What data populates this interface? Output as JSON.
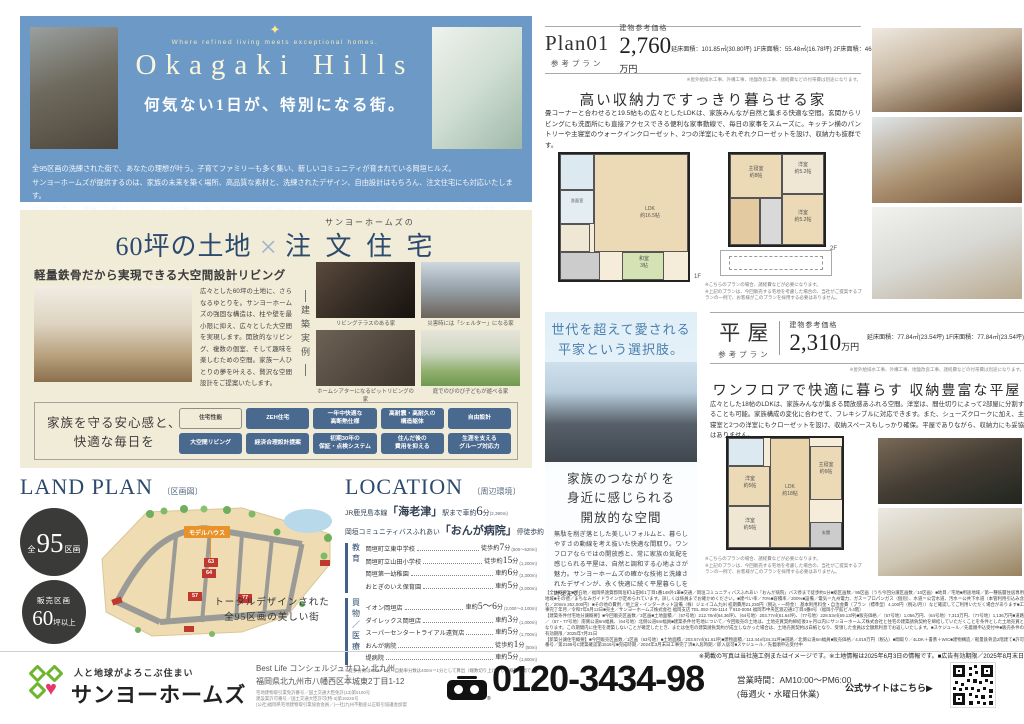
{
  "colors": {
    "hero_blue": "#6d99c6",
    "cream": "#f1ecd8",
    "navy": "#2c4a6e",
    "badge_blue": "#49698f",
    "lot_red": "#c0392f",
    "model_house_orange": "#e8922a",
    "brand_green": "#6cb52d",
    "brand_pink": "#e8366b"
  },
  "hero": {
    "sparkle_icon": "✦",
    "tagline": "Where refined living meets exceptional homes.",
    "title": "Okagaki Hills",
    "subtitle": "何気ない1日が、特別になる街。",
    "body_lines": [
      "全95区画の洗練された街で、あなたの理想が叶う。子育てファミリーも多く集い、新しいコミュニティが育まれている岡垣ヒルズ。",
      "サンヨーホームズが提供するのは、家族の未来を築く場所、高品質な素材と、洗練されたデザイン、自由設計はもちろん、注文住宅にも対応いたします。",
      "災害にも強く、健康にも優しい、安心・安全な暮らしを、岡垣HILLSでお約束します。毎日を特別なものに変える、リゾートのような心地よさを、ぜひご体感ください。"
    ]
  },
  "custom_home": {
    "brand_prefix": "サンヨーホームズの",
    "title_land": "60坪の土地",
    "title_x": "×",
    "title_home": "注 文 住 宅",
    "feature_heading": "軽量鉄骨だから実現できる大空間設計リビング",
    "feature_body": "広々とした60坪の土地に、さらなるゆとりを。サンヨーホームズの強固な構造は、柱や壁を最小限に抑え、広々とした大空間を実現します。開放的なリビング、複数の個室、そして趣味を楽しむための空間。家族一人ひとりの夢を叶える、贅沢な空間設計をご提案いたします。",
    "examples_label": "建築実例",
    "example_captions": [
      "リビングテラスのある家",
      "災害時には「シェルター」になる家",
      "ホームシアターになるピットリビングの家",
      "庭でのびのび子どもが遊べる家"
    ],
    "benefits_lead": "家族を守る安心感と、\n快適な毎日を",
    "badges": [
      "住宅性能",
      "ZEH住宅",
      "一年中快適な\n高断熱仕様",
      "高耐震・高耐久の\n構造躯体",
      "自由設計",
      "大空間リビング",
      "経済合理設計提案",
      "初期30年の\n保証・点検システム",
      "住んだ後の\n費用を抑える",
      "生涯を支える\nグループ対応力"
    ]
  },
  "land_plan": {
    "title": "LAND PLAN",
    "subtitle": "〔区画図〕",
    "circle1": {
      "prefix": "全",
      "number": "95",
      "suffix": "区画"
    },
    "circle2": {
      "line1": "販売区画",
      "number": "60",
      "suffix": "坪以上"
    },
    "model_house_label": "モデルハウス",
    "lots": [
      "63",
      "64",
      "57",
      "77"
    ],
    "caption": "トータルデザインされた\n全95区画の美しい街"
  },
  "location": {
    "title": "LOCATION",
    "subtitle": "〔周辺環境〕",
    "access": [
      {
        "pre": "JR鹿児島本線",
        "name": "「海老津」",
        "mid": "駅まで車約",
        "num": "6",
        "unit": "分",
        "dist": "(2,390m)"
      },
      {
        "pre": "岡垣コミュニティバスふれあい",
        "name": "「おんが病院」",
        "mid": "停徒歩約",
        "num": "1",
        "unit": "分",
        "dist": "(40m)"
      }
    ],
    "groups": [
      {
        "label": "教育",
        "items": [
          {
            "name": "岡垣町立東中学校",
            "mode": "徒歩約",
            "min": "7",
            "unit": "分",
            "dist": "(500〜520m)"
          },
          {
            "name": "岡垣町立山田小学校",
            "mode": "徒歩約",
            "min": "15",
            "unit": "分",
            "dist": "(1,200m)"
          },
          {
            "name": "岡垣第一幼稚園",
            "mode": "車約",
            "min": "6",
            "unit": "分",
            "dist": "(2,300m)"
          },
          {
            "name": "おとぎのいえ保育園",
            "mode": "車約",
            "min": "5",
            "unit": "分",
            "dist": "(2,000m)"
          }
        ]
      },
      {
        "label": "買物／医療",
        "items": [
          {
            "name": "イオン岡垣店",
            "mode": "車約",
            "min": "5〜6",
            "unit": "分",
            "dist": "(2,000〜2,100m)"
          },
          {
            "name": "ダイレックス岡垣店",
            "mode": "車約",
            "min": "3",
            "unit": "分",
            "dist": "(1,000m)"
          },
          {
            "name": "スーパーセンタートライアル遠賀店",
            "mode": "車約",
            "min": "5",
            "unit": "分",
            "dist": "(1,700m)"
          },
          {
            "name": "おんが病院",
            "mode": "徒歩約",
            "min": "1",
            "unit": "分",
            "dist": "(50m)"
          },
          {
            "name": "堤病院",
            "mode": "車約",
            "min": "5",
            "unit": "分",
            "dist": "(1,600m)"
          }
        ]
      }
    ],
    "note": "※徒歩分数は80m＝1分・自動車分数は400m＝1分として算出（端数切り上げ）した概算時間です。"
  },
  "plan01": {
    "name": "Plan01",
    "type_label": "参考プラン",
    "price_label": "建物参考価格",
    "price_value": "2,760",
    "price_unit": "万円",
    "areas": "延床面積：101.85㎡(30.80坪)\n1F床面積：55.48㎡(16.78坪)\n2F床面積：46.37㎡(14.02坪)",
    "price_note": "※屋外給排水工事、外構工事、地盤改良工事、諸経費などの付帯費は別途になります。",
    "headline": "高い収納力ですっきり暮らせる家",
    "body": "畳コーナーと合わせると19.5帖もの広々としたLDKは、家族みんなが自然と集まる快適な空間。玄関からリビングにも洗面所にも直接アクセスできる便利な家事動線で、毎日の家事をスムーズに。キッチン横のパントリーや主寝室のウォークインクローゼット、2つの洋室にもそれぞれクローゼットを設け、収納力も抜群です。",
    "floor1_label": "1F",
    "floor2_label": "2F",
    "rooms_1f": [
      "LDK\n約16.5帖",
      "和室\n3帖",
      "洗面室"
    ],
    "rooms_2f": [
      "主寝室\n約8帖",
      "洋室\n約5.2帖",
      "洋室\n約5.2帖"
    ],
    "plan_note": "※こちらのプランの場合、諸経費などが必要になります。\n※上記のプランは、今回販売する宅地を考慮した場合の、当社がご提案するプランの一例で、お客様がこのプランを採用する必要はありません。"
  },
  "hiraya": {
    "side_title": "世代を超えて愛される\n平家という選択肢。",
    "side_headline": "家族のつながりを\n身近に感じられる\n開放的な空間",
    "side_body": "無駄を削ぎ落とした美しいフォルムと、暮らしやすさの動線を考え抜いた快適な間取り。ワンフロアならではの開放感と、常に家族の気配を感じられる平屋は、自然と調和する心地よさが魅力。サンヨーホームズの確かな技術と洗練されたデザインが、永く快適に続く平屋暮らしを叶えます。",
    "name": "平 屋",
    "type_label": "参考プラン",
    "price_label": "建物参考価格",
    "price_value": "2,310",
    "price_unit": "万円",
    "areas": "延床面積：77.84㎡(23.54坪)\n1F床面積：77.84㎡(23.54坪)",
    "price_note": "※屋外給排水工事、外構工事、地盤改良工事、諸経費などの付帯費は別途になります。",
    "headline": "ワンフロアで快適に暮らす 収納豊富な平屋",
    "body": "広々とした18帖のLDKは、家族みんなが集まる開放感あふれる空間。洋室は、間仕切りによって2部屋に分割することも可能。家族構成の変化に合わせて、フレキシブルに対応できます。また、シューズクロークに加え、主寝室と2つの洋室にもクローゼットを設け、収納スペースもしっかり確保。平屋でありながら、収納力にも妥協はありません。",
    "rooms": [
      "LDK\n約18帖",
      "主寝室\n約6帖",
      "洋室\n約5帖",
      "洋室\n約5帖",
      "玄関"
    ],
    "plan_note": "※こちらのプランの場合、諸経費などが必要になります。\n※上記のプランは、今回販売する宅地を考慮した場合の、当社がご提案するプランの一例で、お客様がこのプランを採用する必要はありません。"
  },
  "fine_print": {
    "lines": [
      "【全体概要】■所在地／福岡県遠賀郡岡垣町山田峠1丁目1番148外1筆■交通／岡垣コミュニティバスふれあい「おんが病院」バス停まで徒歩約1分■総区画数／95区画（うち今回分譲区画数／10区画）■地目／宅地■用途地域／第一種低層住居専用地域■その他／まちなみガイドラインが定められています。詳しくは係員までお確かめください。■建ぺい率／70%■容積率／200%■設備／電気＝九州電力、ガス＝プロパンガス（個別）、水道＝公営水道、汚水＝公共下水道（本管利用引込み含む／20mm 252,000円）■その他の費用／地上波・インターネット設備（株）ジェイコム九州 初期費用21,230円（税込・一時金） 基本利用料金・自治会費（プラン（標準型）4,100円（税込/月））など確認してご利用いただく場合があります■工事完了年月／令和7年6月12日■売主／サンヨーホームズ株式会社 福岡支店 TEL.092-736-1114 〒810-0004 福岡市中央区渡辺通2丁目4番8号（福岡小学館ビル4階）",
      "【建築条件付宅地分譲概要】■今回販売区画数／3区画■土地面積／（57号地）212.78㎡(64.36坪)、（64号地）203.77㎡(61.64坪)、（77号地）228.53㎡(69.13坪)■販売価格／（57号地）1,056万円、（64号地）7,313万円、（77号地）1,136万円■道路／（57・77号地）南側公道6m幅員、（64号地）北側公道6m幅員■建築条件付宅地について／今回販売の土地は、土地売買契約締結後3ヶ月以内にサンヨーホームズ株式会社と住宅の建築請負契約を締結していただくことを条件とした土地売買となります。この期間内に住宅を建築しないことが確定したとき、または住宅の建築請負契約が成立しなかった場合は、土地売買契約は白紙となり、受領した金員は全額無利息でお返しいたします。■スケジュール／先着順申込受付中■販売条件の有効期限／2025年7月31日",
      "【新築分譲住宅概要】■今回販売区画数／1区画（63号地）■土地面積／203.67㎡(61.61坪)■建物面積／113.44㎡(34.31坪)■道路／北側公道6m幅員■販売価格／4,019万円（税込）■間取り／4LDK＋書斎＋WIC■建物構造／軽量鉄骨造2階建て■許可番号／第2169号C建築確認第1516号■完成時期／2024年3月末日工事完了済■入居時期／即入居可■スケジュール／先着順申込受付中"
    ],
    "final_note": "※掲載の写真は当社施工例またはイメージです。※土地情報は2025年6月3日の情報です。■広告有効期限／2025年8月末日"
  },
  "footer": {
    "logo_tagline": "人と地球がよろこぶ住まい",
    "logo_name": "サンヨーホームズ",
    "office_name": "Best Life コンシェルジュサロン 北九州",
    "office_address": "福岡県北九州市八幡西区本城東2丁目1-12",
    "license_lines": "宅地建物取引業免許番号／国土交通大臣免許(13)第6100号\n建設業許可番号／国土交通大臣許可(特-3)第19226号\n(公社)福岡県宅地建物取引業協会会員／(一社)九州不動産公正取引協議会加盟",
    "freedial_reg": "®",
    "phone": "0120-3434-98",
    "hours": "営業時間：AM10:00～PM6:00",
    "holiday": "(毎週火・水曜日休業)",
    "website_cta": "公式サイトはこちら▶"
  }
}
